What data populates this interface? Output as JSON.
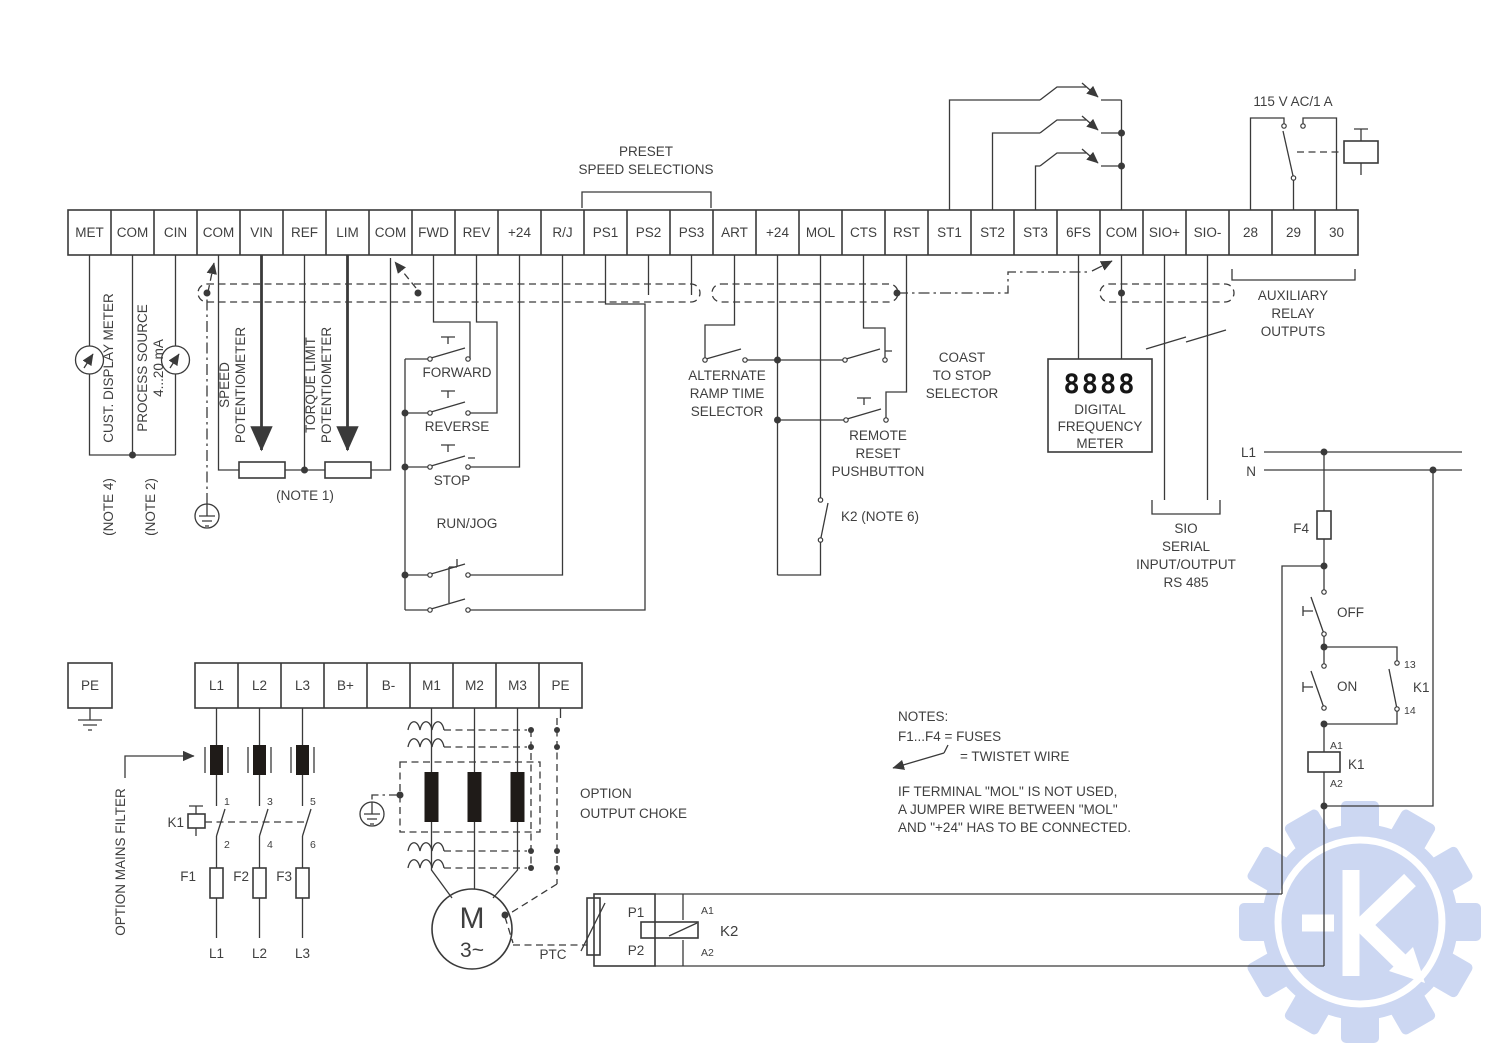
{
  "top_strip": {
    "labels": [
      "MET",
      "COM",
      "CIN",
      "COM",
      "VIN",
      "REF",
      "LIM",
      "COM",
      "FWD",
      "REV",
      "+24",
      "R/J",
      "PS1",
      "PS2",
      "PS3",
      "ART",
      "+24",
      "MOL",
      "CTS",
      "RST",
      "ST1",
      "ST2",
      "ST3",
      "6FS",
      "COM",
      "SIO+",
      "SIO-",
      "28",
      "29",
      "30"
    ]
  },
  "bottom_strip": {
    "labels": [
      "L1",
      "L2",
      "L3",
      "B+",
      "B-",
      "M1",
      "M2",
      "M3",
      "PE"
    ]
  },
  "pe_terminal": {
    "label": "PE"
  },
  "annotations": {
    "preset": [
      "PRESET",
      "SPEED SELECTIONS"
    ],
    "voltage": "115 V AC/1 A",
    "aux_relay": [
      "AUXILIARY",
      "RELAY",
      "OUTPUTS"
    ],
    "cust_meter": "CUST. DISPLAY METER",
    "note4": "(NOTE 4)",
    "process_source": [
      "PROCESS SOURCE",
      "4...20 mA"
    ],
    "note2": "(NOTE 2)",
    "speed_pot": [
      "SPEED",
      "POTENTIOMETER"
    ],
    "torque_pot": [
      "TORQUE LIMIT",
      "POTENTIOMETER"
    ],
    "note1": "(NOTE 1)",
    "forward": "FORWARD",
    "reverse": "REVERSE",
    "stop": "STOP",
    "run_jog": "RUN/JOG",
    "alt_ramp": [
      "ALTERNATE",
      "RAMP TIME",
      "SELECTOR"
    ],
    "coast": [
      "COAST",
      "TO STOP",
      "SELECTOR"
    ],
    "remote_reset": [
      "REMOTE",
      "RESET",
      "PUSHBUTTON"
    ],
    "k2_note": "K2 (NOTE 6)",
    "dfm": {
      "digits": "8888",
      "lines": [
        "DIGITAL",
        "FREQUENCY",
        "METER"
      ]
    },
    "sio": [
      "SIO",
      "SERIAL",
      "INPUT/OUTPUT",
      "RS 485"
    ],
    "l1_rail": "L1",
    "n_rail": "N",
    "f4": "F4",
    "off": "OFF",
    "on": "ON",
    "k1": "K1",
    "c13": "13",
    "c14": "14",
    "a1": "A1",
    "a2": "A2",
    "mains_filter": "OPTION MAINS FILTER",
    "fuses": [
      "F1",
      "F2",
      "F3"
    ],
    "phase_labels": [
      "L1",
      "L2",
      "L3"
    ],
    "contact_numbers": [
      "1",
      "2",
      "3",
      "4",
      "5",
      "6"
    ],
    "output_choke": [
      "OPTION",
      "OUTPUT CHOKE"
    ],
    "motor": {
      "m": "M",
      "phase": "3~"
    },
    "ptc": "PTC",
    "p1": "P1",
    "p2": "P2",
    "k2": "K2",
    "notes": [
      "NOTES:",
      "F1...F4 = FUSES",
      "= TWISTET WIRE",
      "IF TERMINAL \"MOL\" IS NOT USED,",
      "A JUMPER WIRE BETWEEN \"MOL\"",
      "AND \"+24\" HAS TO BE CONNECTED."
    ]
  },
  "colors": {
    "wire": "#3a3a3a",
    "watermark": "#ccd7f2"
  }
}
